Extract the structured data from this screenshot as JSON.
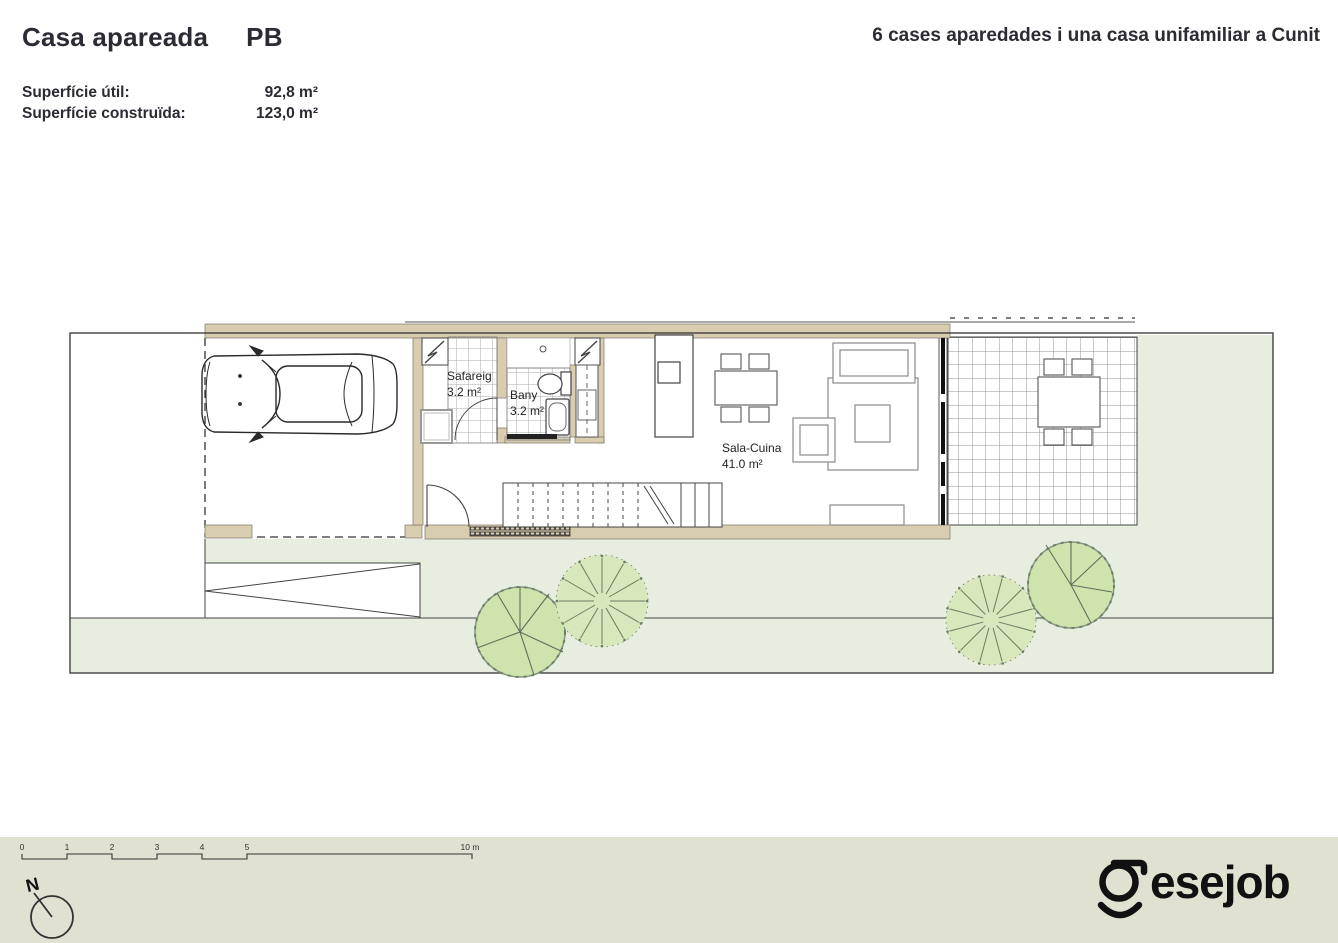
{
  "header": {
    "title": "Casa apareada",
    "floor_code": "PB",
    "project_title": "6 cases aparedades i una casa unifamiliar a Cunit",
    "metrics": [
      {
        "label": "Superfície útil:",
        "value": "92,8 m²"
      },
      {
        "label": "Superfície construïda:",
        "value": "123,0 m²"
      }
    ]
  },
  "plan": {
    "rooms": [
      {
        "name": "Safareig",
        "area": "3.2 m²"
      },
      {
        "name": "Bany",
        "area": "3.2 m²"
      },
      {
        "name": "Sala-Cuina",
        "area": "41.0 m²"
      }
    ]
  },
  "scale_bar": {
    "tick_labels": [
      "0",
      "1",
      "2",
      "3",
      "4",
      "5"
    ],
    "end_label": "10 m"
  },
  "compass": {
    "north_label": "N"
  },
  "branding": {
    "logo_text": "esejob"
  },
  "icons": {
    "compass": "north-arrow-icon",
    "vehicle": "car-top-view-icon",
    "vegetation": "tree-icon",
    "logo_mark": "gesejob-g-smile-icon"
  },
  "colors": {
    "wall": "#d9cdb0",
    "garden_green": "#e7eedf",
    "footer_band": "#e1e1d2",
    "tree_green": "#cfe3ad",
    "ink": "#2b2b33"
  }
}
